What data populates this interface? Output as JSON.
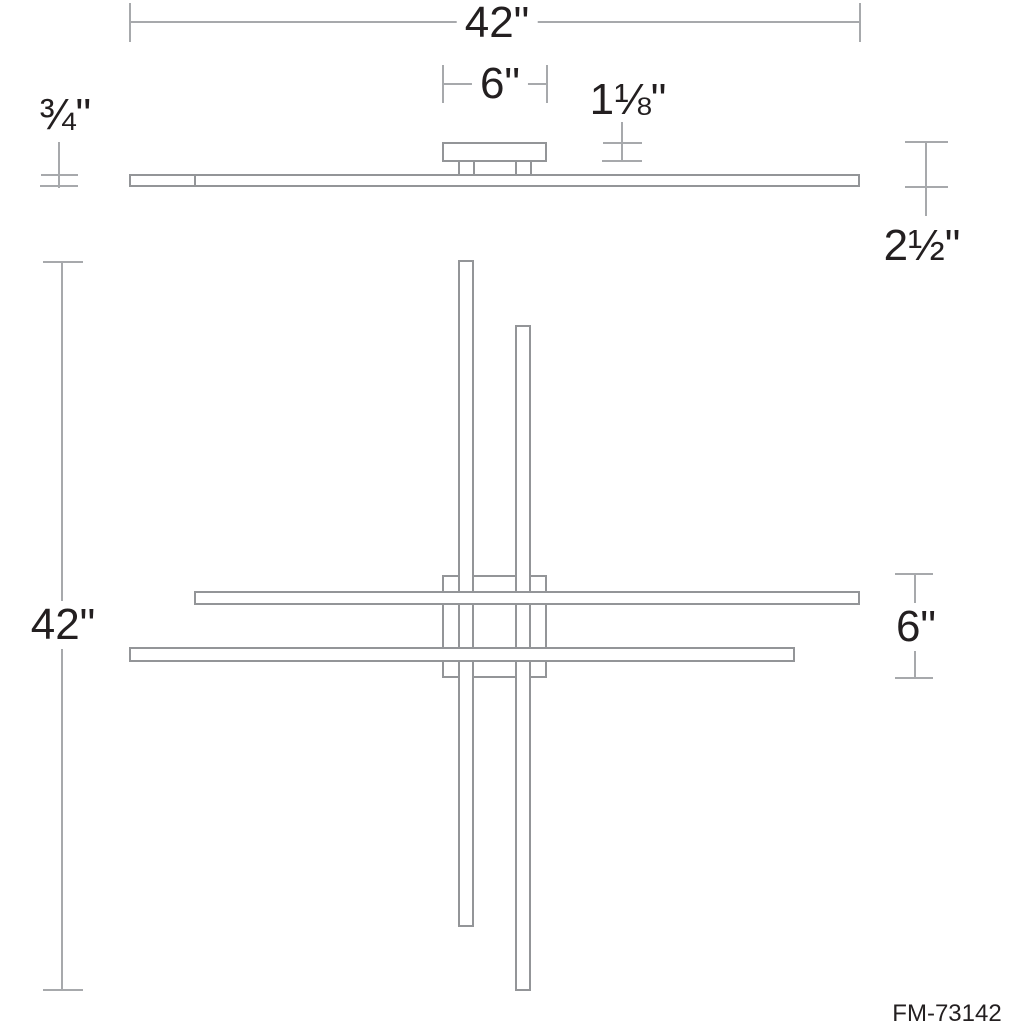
{
  "drawing": {
    "model_number": "FM-73142",
    "labels": {
      "overall_width": "42\"",
      "canopy_width": "6\"",
      "canopy_height": "1⅛\"",
      "bar_thickness": "¾\"",
      "fixture_height": "2½\"",
      "overall_length": "42\"",
      "canopy_plan_size": "6\""
    },
    "colors": {
      "dimension_line": "#a7a9ac",
      "fixture_outline": "#939598",
      "label_text": "#231f20",
      "background": "#ffffff"
    }
  }
}
